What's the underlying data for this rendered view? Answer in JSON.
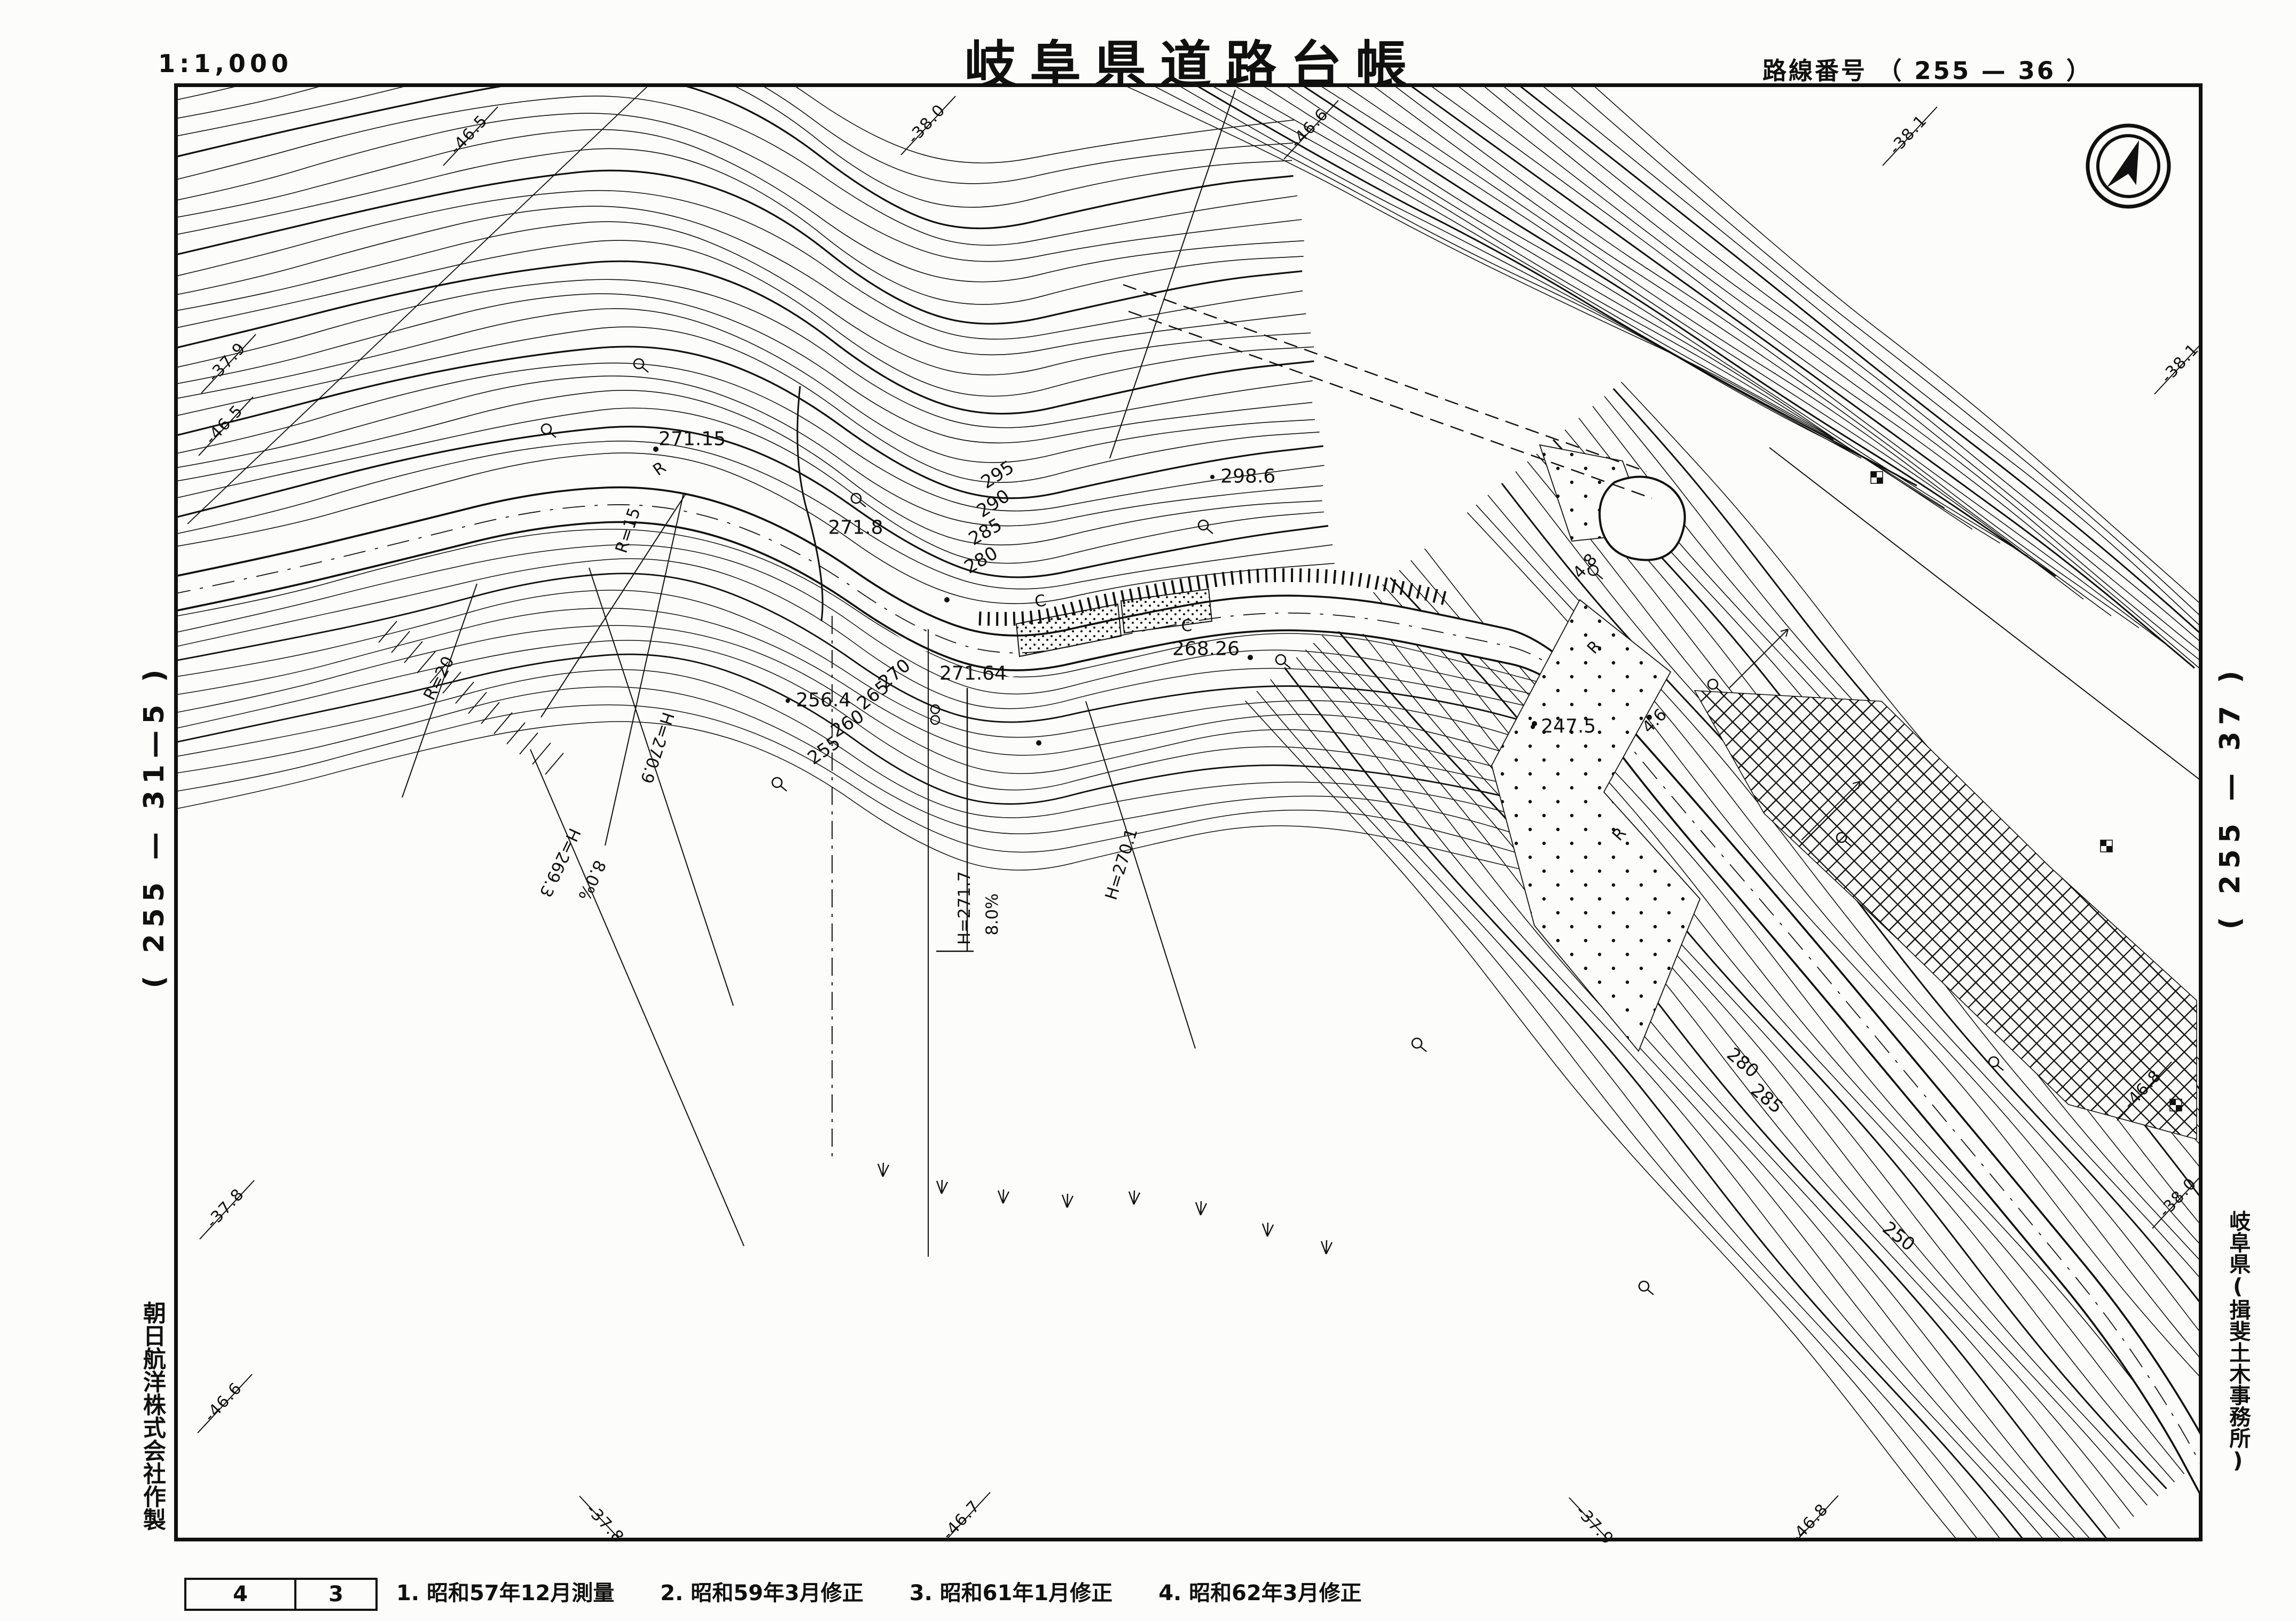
{
  "header": {
    "scale": "1:1,000",
    "title": "岐阜県道路台帳",
    "route": "路線番号 （ 255 — 36 ）"
  },
  "side_refs": {
    "left_sheet": "( 255 — 31—5 )",
    "right_sheet": "( 255 — 37 )",
    "maker": "朝日航洋株式会社作製",
    "office": "岐阜県(揖斐土木事務所)"
  },
  "footer": {
    "sheet_cells": [
      "4",
      "3"
    ],
    "revisions": [
      "1. 昭和57年12月測量",
      "2. 昭和59年3月修正",
      "3. 昭和61年1月修正",
      "4. 昭和62年3月修正"
    ]
  },
  "north_arrow": "north-arrow-icon",
  "grid_ticks": {
    "top": [
      "-46.5",
      "-38.0",
      "-46.6",
      "-38.1"
    ],
    "left": [
      "-37.9",
      "-46.5",
      "-37.8",
      "-46.6"
    ],
    "right": [
      "-38.1",
      "-46.8",
      "-38.0"
    ],
    "bottom": [
      "-37.8",
      "-46.7",
      "-37.9",
      "-46.8"
    ]
  },
  "map_labels": {
    "contours": [
      "295",
      "290",
      "285",
      "280",
      "270",
      "265",
      "260",
      "255",
      "280",
      "285",
      "250"
    ],
    "spots": [
      "271.15",
      "271.8",
      "298.6",
      "268.26",
      "271.64",
      "256.4",
      "247.5"
    ],
    "sections": [
      "R=15",
      "R=20",
      "H=270.9",
      "H=269.3",
      "8.0%",
      "H=271.7",
      "8.0%",
      "H=270.1"
    ],
    "measurements": [
      "4.6",
      "4.8"
    ],
    "road_letters": [
      "R",
      "R",
      "R",
      "C",
      "C"
    ]
  },
  "colors": {
    "ink": "#101010",
    "paper": "#fcfcfa"
  }
}
